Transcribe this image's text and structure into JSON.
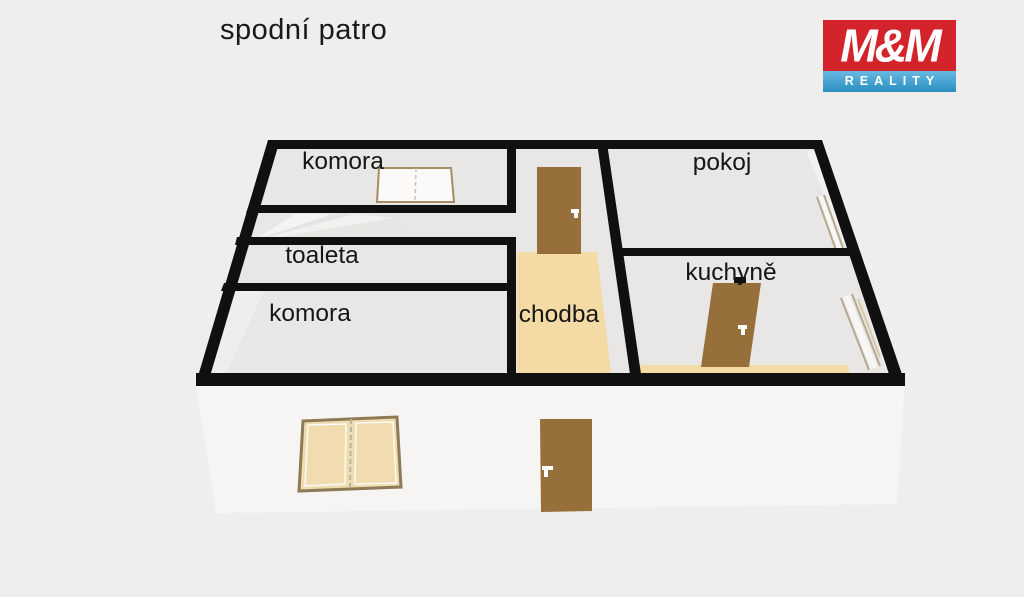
{
  "page": {
    "title": "spodní patro",
    "background": "#efeeec"
  },
  "logo": {
    "mm": "M&M",
    "reality": "REALITY",
    "red": "#d3232b",
    "blue": "#2d9fd6"
  },
  "floorplan": {
    "rooms": [
      {
        "name": "komora-top",
        "label": "komora"
      },
      {
        "name": "toaleta",
        "label": "toaleta"
      },
      {
        "name": "komora-left",
        "label": "komora"
      },
      {
        "name": "chodba",
        "label": "chodba"
      },
      {
        "name": "pokoj",
        "label": "pokoj"
      },
      {
        "name": "kuchyne",
        "label": "kuchyně"
      }
    ],
    "colors": {
      "wall": "#101010",
      "room": "#e9e7e5",
      "front_face": "#f6f5f3",
      "floor_accent": "#f4dba5",
      "door": "#966f3b",
      "window_pane": "#f0dcae",
      "window_frame": "#8f7a57"
    }
  }
}
